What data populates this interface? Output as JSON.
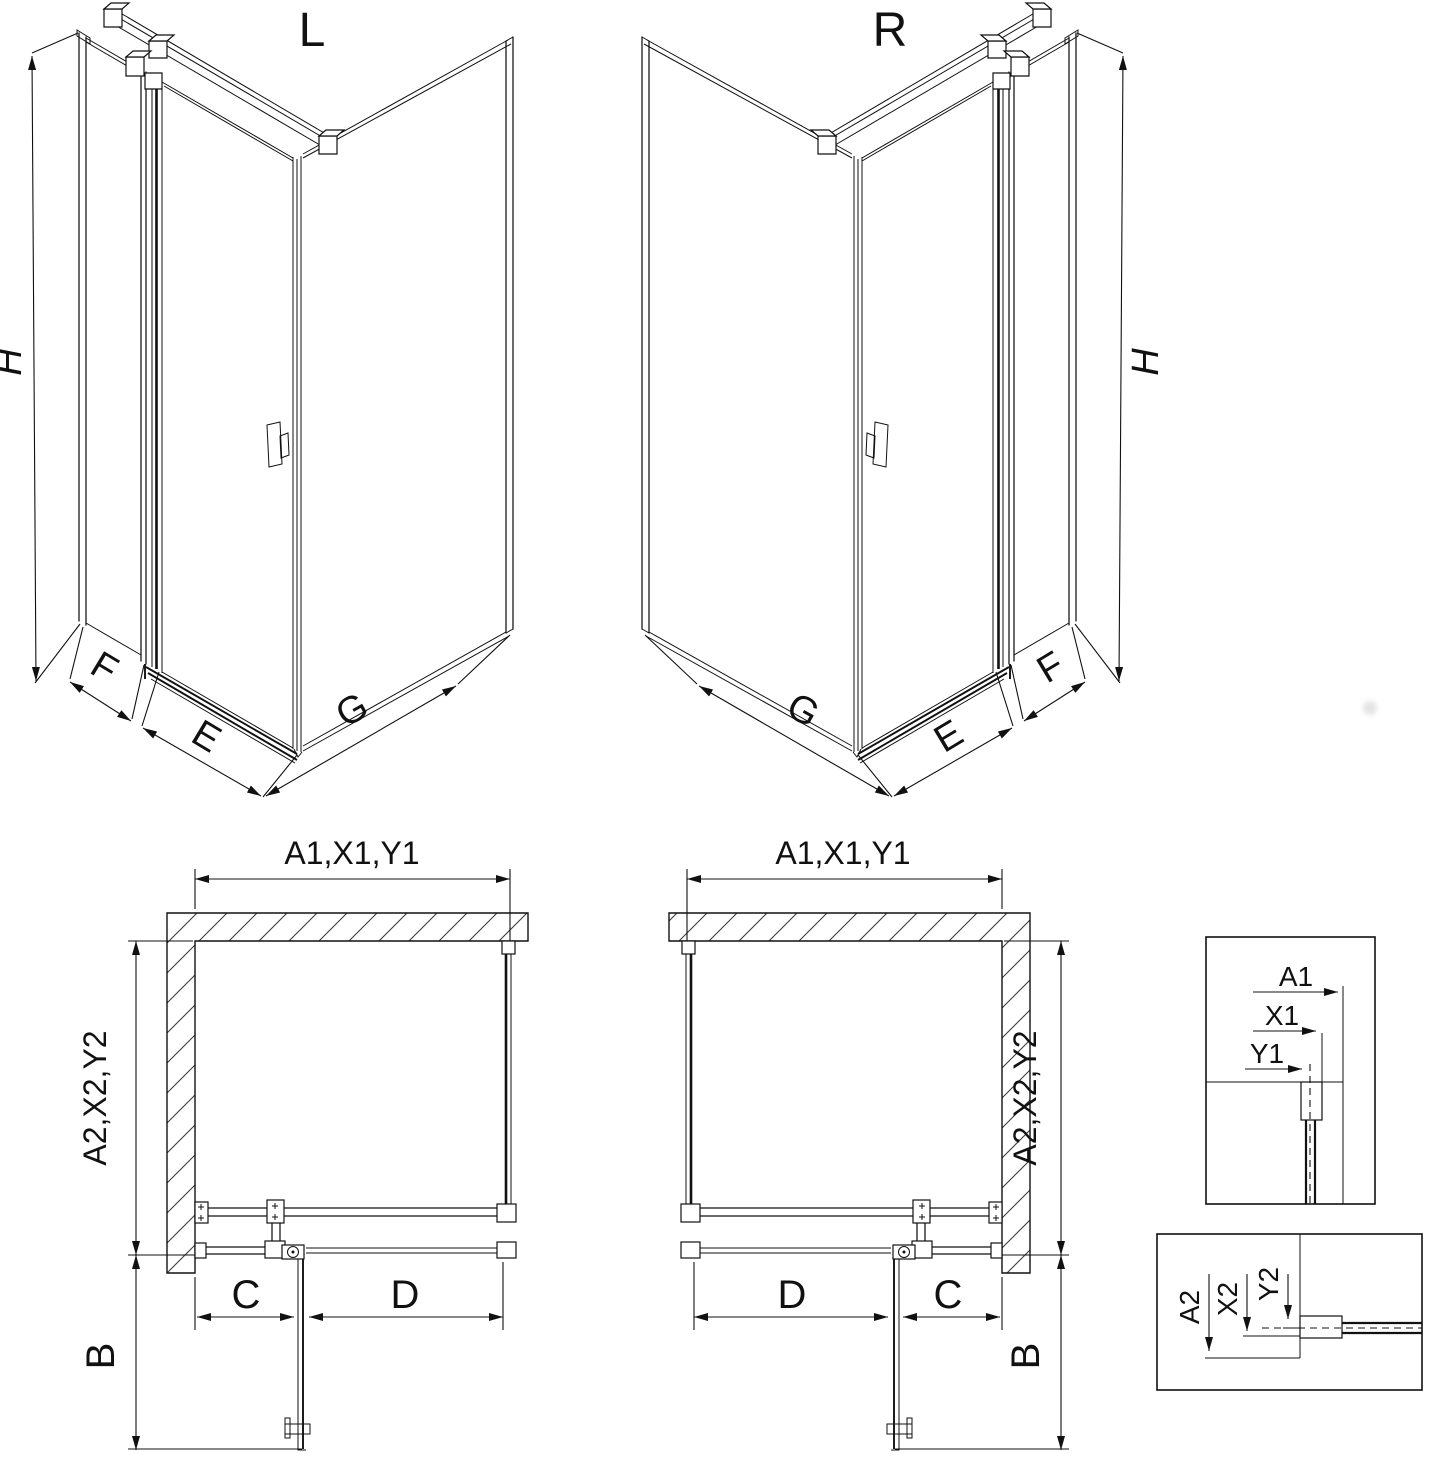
{
  "figure": {
    "iso_left": {
      "title": "L",
      "height": "H",
      "front_fixed": "F",
      "door": "E",
      "side": "G"
    },
    "iso_right": {
      "title": "R",
      "height": "H",
      "front_fixed": "F",
      "door": "E",
      "side": "G"
    },
    "plan_left": {
      "width": "A1,X1,Y1",
      "depth": "A2,X2,Y2",
      "fixed": "C",
      "door": "D",
      "swing": "B"
    },
    "plan_right": {
      "width": "A1,X1,Y1",
      "depth": "A2,X2,Y2",
      "fixed": "C",
      "door": "D",
      "swing": "B"
    },
    "detail_width": {
      "outer": "A1",
      "mid": "X1",
      "inner": "Y1"
    },
    "detail_depth": {
      "outer": "A2",
      "mid": "X2",
      "inner": "Y2"
    }
  }
}
